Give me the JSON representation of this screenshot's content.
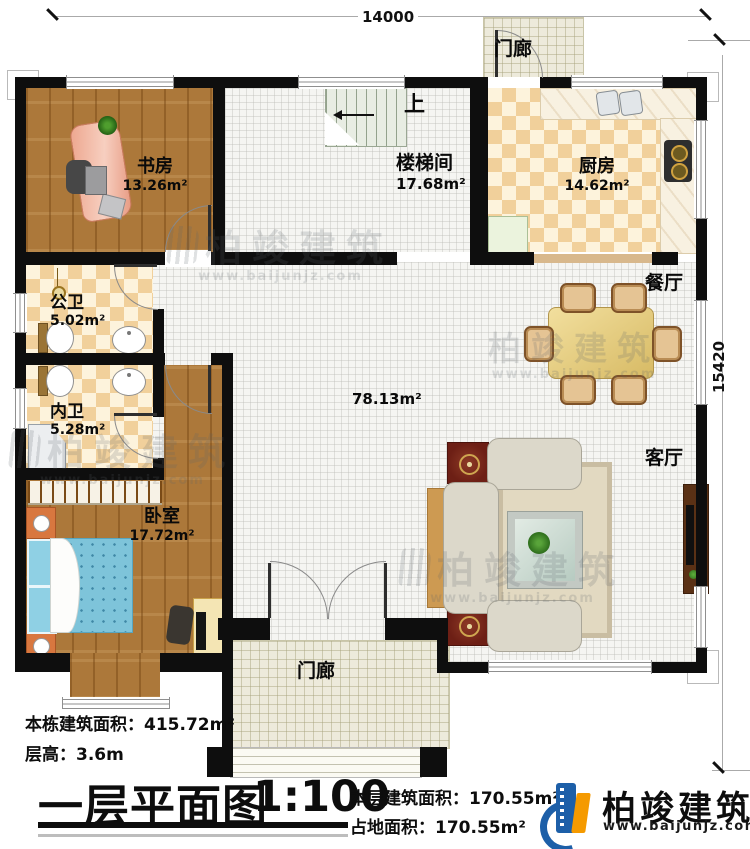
{
  "dimensions": {
    "width": "14000",
    "height": "15420"
  },
  "rooms": {
    "study": {
      "name": "书房",
      "area": "13.26m²"
    },
    "stairwell": {
      "name": "楼梯间",
      "area": "17.68m²"
    },
    "up": "上",
    "kitchen": {
      "name": "厨房",
      "area": "14.62m²"
    },
    "porch_top": {
      "name": "门廊"
    },
    "dining": {
      "name": "餐厅"
    },
    "public_bath": {
      "name": "公卫",
      "area": "5.02m²"
    },
    "private_bath": {
      "name": "内卫",
      "area": "5.28m²"
    },
    "bedroom": {
      "name": "卧室",
      "area": "17.72m²"
    },
    "living": {
      "name": "客厅"
    },
    "hall": {
      "area": "78.13m²"
    },
    "porch_bottom": {
      "name": "门廊"
    }
  },
  "footer": {
    "building_area": "本栋建筑面积：415.72m²",
    "floor_height": "层高：3.6m",
    "plan_title": "一层平面图",
    "scale": "1:100",
    "floor_area": "本层建筑面积：170.55m²",
    "footprint_area": "占地面积：170.55m²"
  },
  "brand": {
    "name": "柏竣建筑",
    "website": "www.baijunjz.com"
  }
}
